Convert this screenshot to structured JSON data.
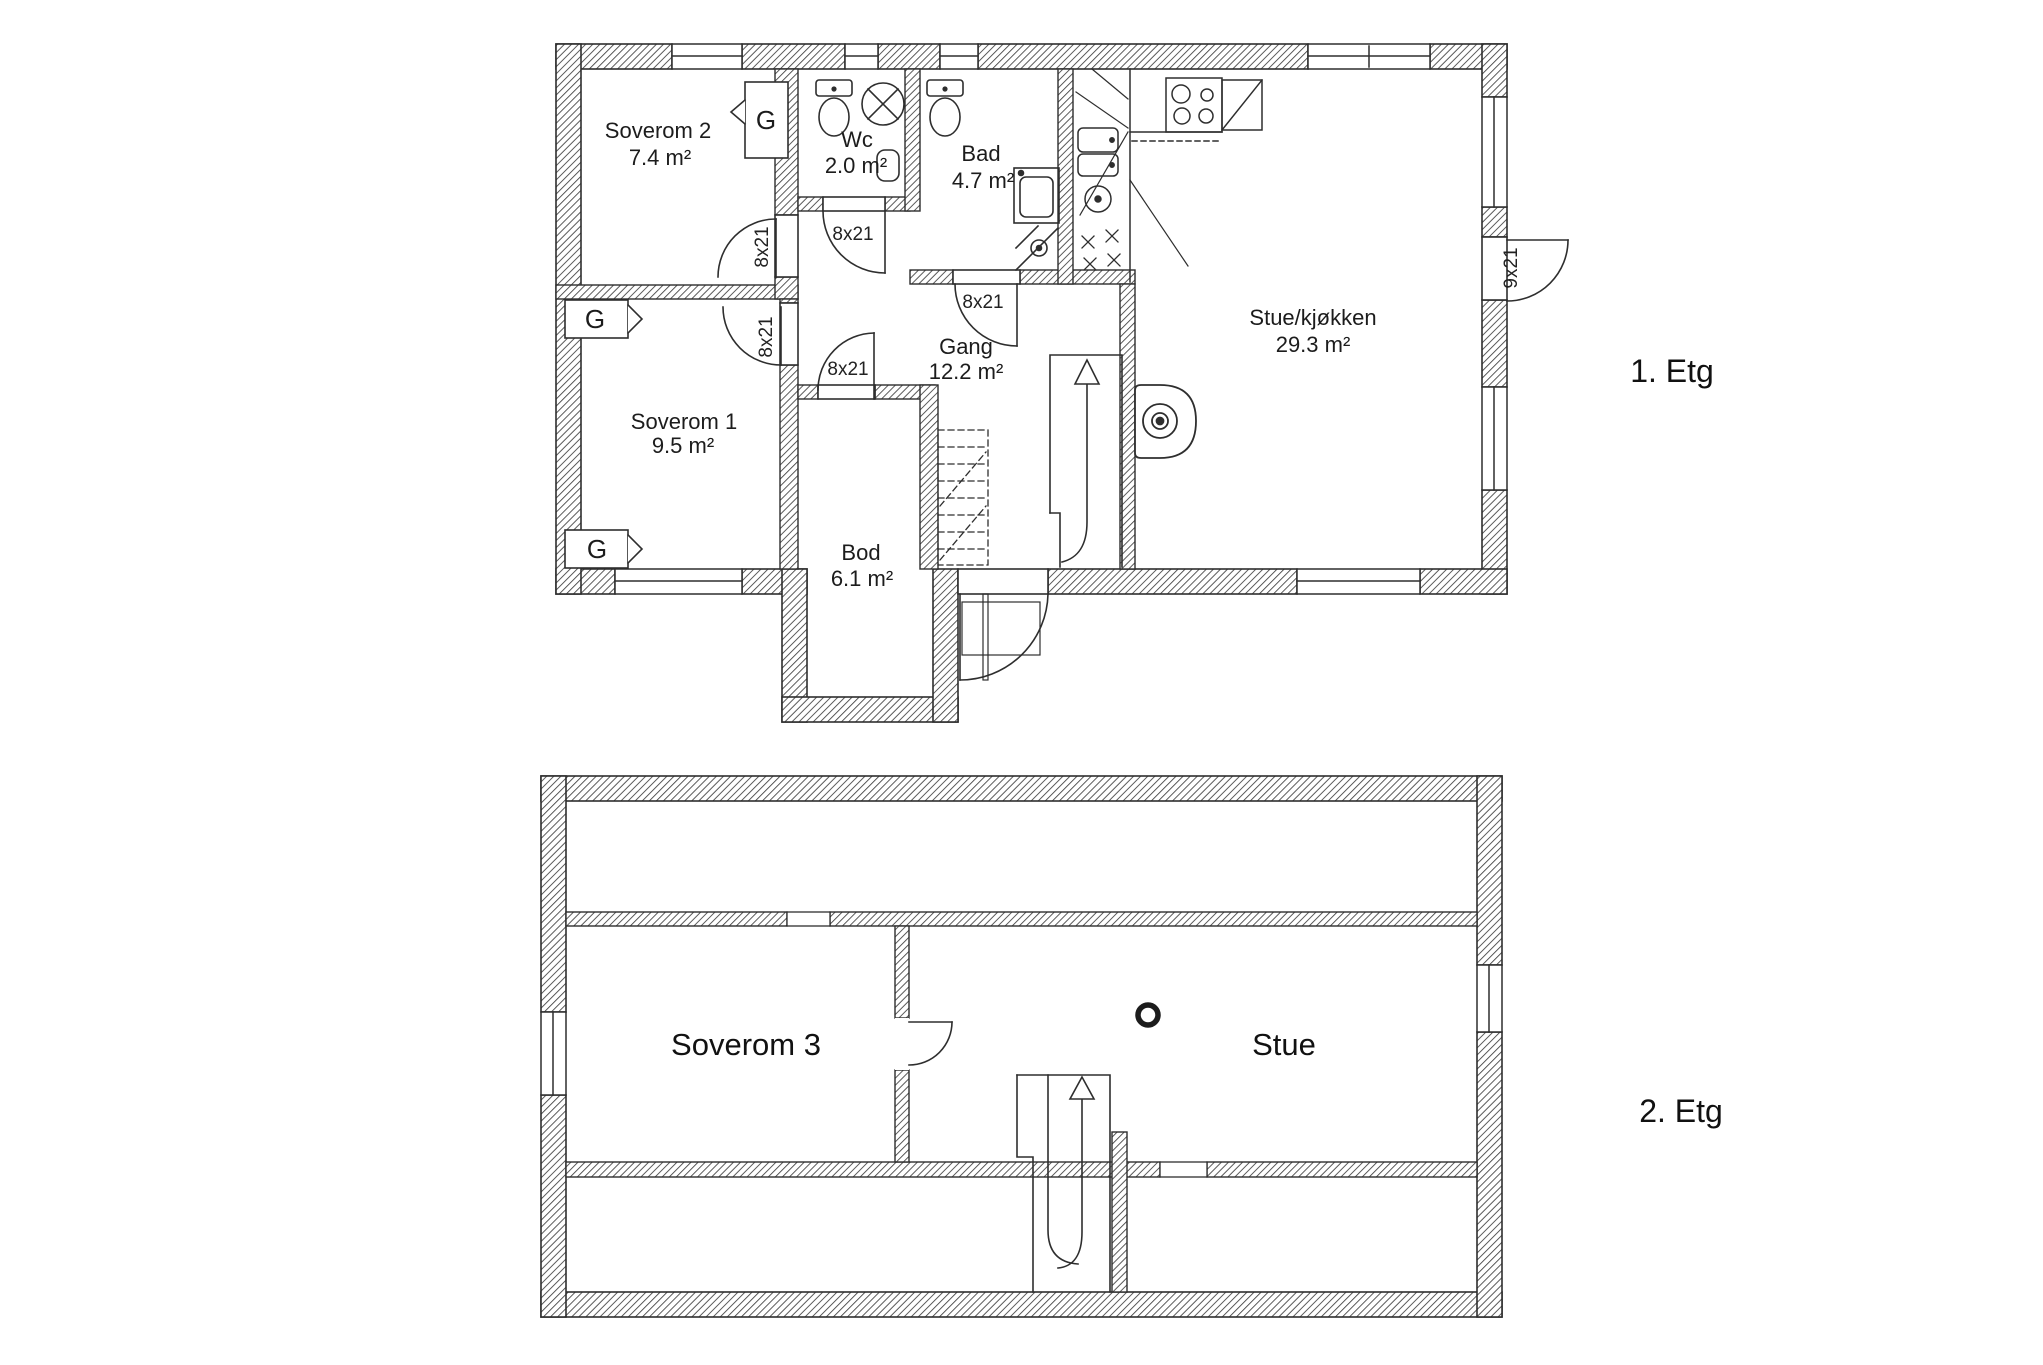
{
  "floor1": {
    "label": "1. Etg",
    "rooms": {
      "soverom2": {
        "name": "Soverom 2",
        "area": "7.4 m²"
      },
      "wc": {
        "name": "Wc",
        "area": "2.0 m²"
      },
      "bad": {
        "name": "Bad",
        "area": "4.7 m²"
      },
      "stue_kjokken": {
        "name": "Stue/kjøkken",
        "area": "29.3 m²"
      },
      "gang": {
        "name": "Gang",
        "area": "12.2 m²"
      },
      "soverom1": {
        "name": "Soverom 1",
        "area": "9.5 m²"
      },
      "bod": {
        "name": "Bod",
        "area": "6.1 m²"
      }
    },
    "doors": {
      "interior_size": "8x21",
      "entry_size": "9x21"
    },
    "wardrobe_label": "G"
  },
  "floor2": {
    "label": "2. Etg",
    "rooms": {
      "soverom3": {
        "name": "Soverom 3"
      },
      "stue": {
        "name": "Stue"
      }
    }
  },
  "colors": {
    "line": "#2e2e2e",
    "paper": "#ffffff"
  }
}
